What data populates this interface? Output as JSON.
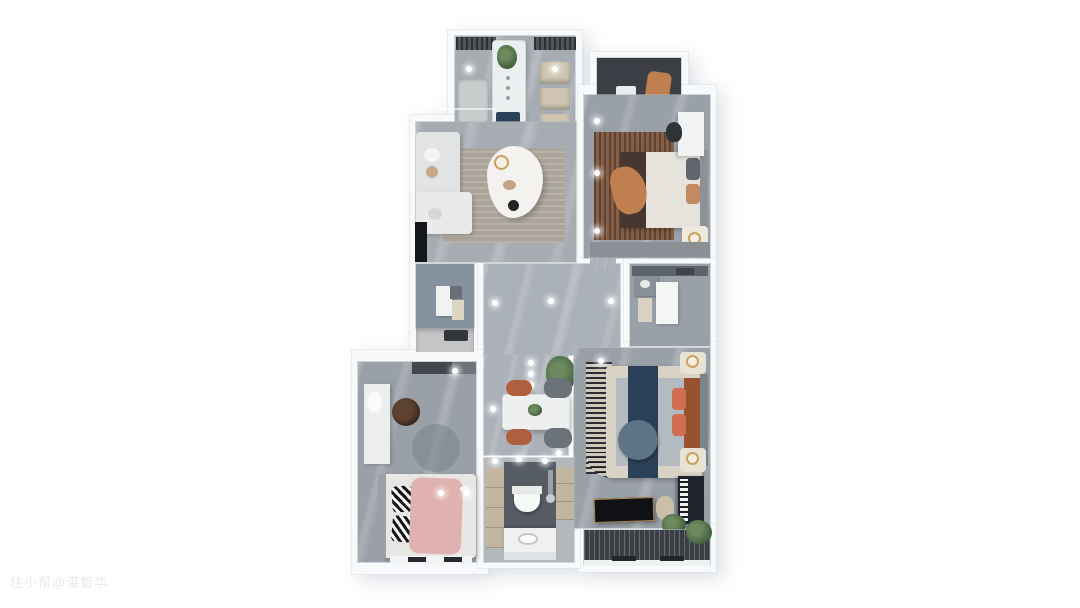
{
  "watermark": {
    "text": "住小帮@湛智华"
  },
  "palette": {
    "wall": "#f7f9fa",
    "floor": "#a7acb3",
    "floorDark": "#9aa0a8",
    "hallFloor": "#abb1b8",
    "darkCabinet": "#454a51",
    "beige": "#cfc5b2",
    "island": "#eceff0",
    "navy": "#2b4058",
    "rust": "#99522f",
    "rugRust": "#7a523a",
    "coral": "#cf6f4f",
    "pink": "#e0b1b1",
    "orange": "#bf7f4e",
    "balconyDark": "#3b3f45",
    "green": "#4c6a45",
    "gold": "#c9a35c",
    "white": "#eef0f1"
  },
  "scene": {
    "type": "3d-rendered apartment floor plan, top-down view on white background",
    "rooms": [
      {
        "name": "foyer-kitchen",
        "features": [
          "dark wall cabinets",
          "white display island with plant",
          "beige shelf cubes",
          "downlights"
        ]
      },
      {
        "name": "living-room",
        "features": [
          "light L-sofa on left wall",
          "cloud-shaped white coffee table",
          "tan area rug",
          "black TV panel"
        ]
      },
      {
        "name": "master-bedroom",
        "features": [
          "white bed with dark runner and orange throw",
          "rust distressed rug",
          "white vanity desk",
          "gold clock tray",
          "downlights"
        ]
      },
      {
        "name": "master-balcony",
        "features": [
          "dark floor",
          "washer box",
          "tan lounge chair"
        ]
      },
      {
        "name": "small-room-kitchenette",
        "features": [
          "blue-gray wall",
          "white and beige wall cabinets",
          "gray counter with dark cooktop"
        ]
      },
      {
        "name": "hallway-dining",
        "features": [
          "white dining table",
          "two terracotta chairs",
          "two gray chairs",
          "potted plant",
          "recessed light dots"
        ]
      },
      {
        "name": "bathroom-small",
        "features": [
          "dark top band",
          "vanity unit",
          "white screen",
          "beige mat"
        ]
      },
      {
        "name": "second-bedroom",
        "features": [
          "gray bed with navy runner",
          "round blue-gray cushion",
          "coral pillows",
          "striped curved rug",
          "two nightstands with gold clocks",
          "black desk with gold trim",
          "upright piano",
          "plants"
        ]
      },
      {
        "name": "south-balcony",
        "features": [
          "dark slatted floor",
          "green plant",
          "white sill"
        ]
      },
      {
        "name": "third-bedroom",
        "features": [
          "bed with pink blanket",
          "zebra pillows",
          "white desk",
          "brown round chair",
          "round gray rug",
          "dark wardrobe band"
        ]
      },
      {
        "name": "bathroom-main",
        "features": [
          "beige storage cabinets",
          "dark wet-wall",
          "wall-hung toilet",
          "white vanity with sink",
          "mirror lights"
        ]
      }
    ]
  }
}
